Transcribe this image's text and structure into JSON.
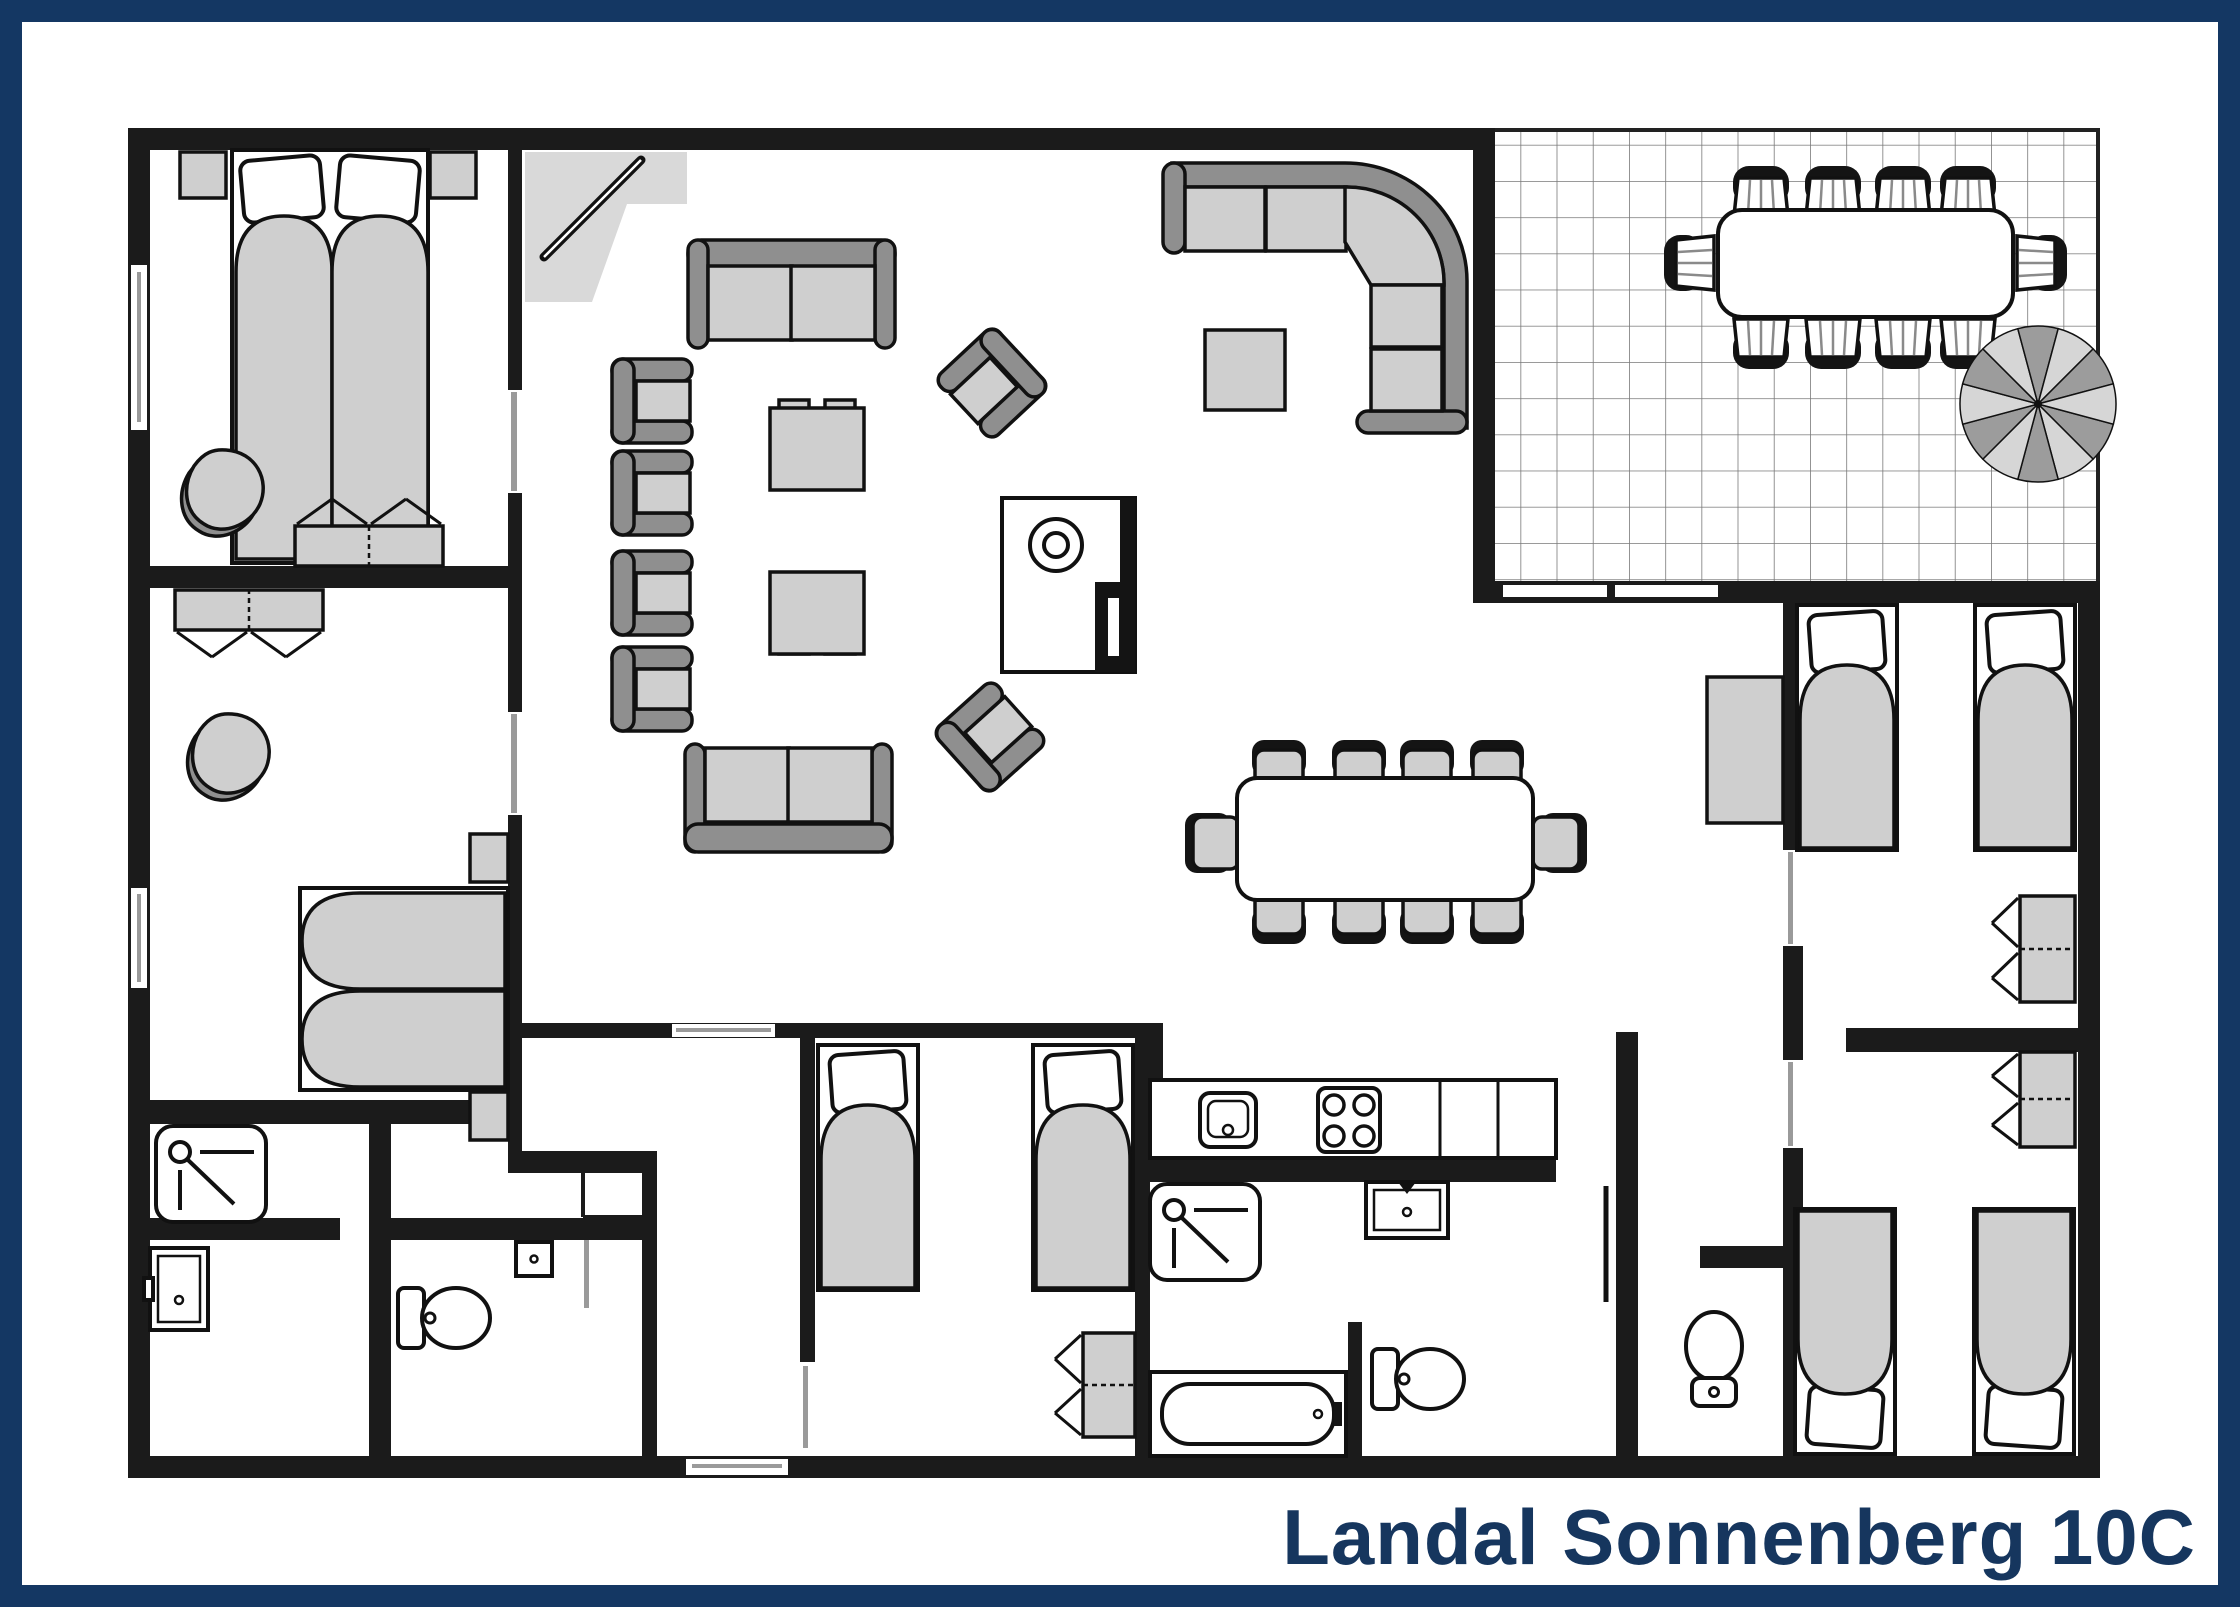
{
  "title": {
    "text": "Landal Sonnenberg 10C"
  },
  "colors": {
    "frame": "#143763",
    "title": "#16365e",
    "wall": "#1b1b1b",
    "line": "#111111",
    "furn": "#cfcfcf",
    "dark": "#8f8f8f",
    "grid": "#787878"
  },
  "floor_plan": {
    "type": "top-down 2D holiday-home floor plan",
    "rooms": [
      {
        "name": "bedroom-top-left",
        "furniture": [
          "double bed",
          "2 nightstands",
          "lounge chair",
          "double wardrobe"
        ]
      },
      {
        "name": "bedroom-middle-left",
        "furniture": [
          "double bed",
          "2 nightstands",
          "lounge chair",
          "double wardrobe"
        ]
      },
      {
        "name": "shower-room-left",
        "furniture": [
          "shower",
          "washbasin"
        ]
      },
      {
        "name": "wc-left",
        "furniture": [
          "toilet",
          "hand basin"
        ]
      },
      {
        "name": "living-room",
        "furniture": [
          "2-seat sofa",
          "2-seat sofa",
          "corner sofa",
          "4 armchairs",
          "2 angled armchairs",
          "2 coffee tables",
          "square side table",
          "wood stove / fireplace",
          "entrance mat with door"
        ]
      },
      {
        "name": "dining-area",
        "furniture": [
          "dining table",
          "10 chairs"
        ]
      },
      {
        "name": "kitchen",
        "furniture": [
          "worktop",
          "sink",
          "4-burner hob"
        ]
      },
      {
        "name": "bathroom",
        "furniture": [
          "shower",
          "washbasin",
          "bathtub",
          "toilet"
        ]
      },
      {
        "name": "wc-right",
        "furniture": [
          "toilet"
        ]
      },
      {
        "name": "hallway",
        "furniture": [
          "cabinet"
        ]
      },
      {
        "name": "bedroom-middle-right",
        "furniture": [
          "2 single beds",
          "wardrobe"
        ]
      },
      {
        "name": "bedroom-bottom-middle",
        "furniture": [
          "2 single beds",
          "wardrobe"
        ]
      },
      {
        "name": "bedroom-bottom-right",
        "furniture": [
          "2 single beds",
          "wardrobe"
        ]
      },
      {
        "name": "terrace",
        "flooring": "tiles",
        "furniture": [
          "outdoor dining table",
          "10 garden chairs",
          "parasol"
        ]
      }
    ]
  }
}
